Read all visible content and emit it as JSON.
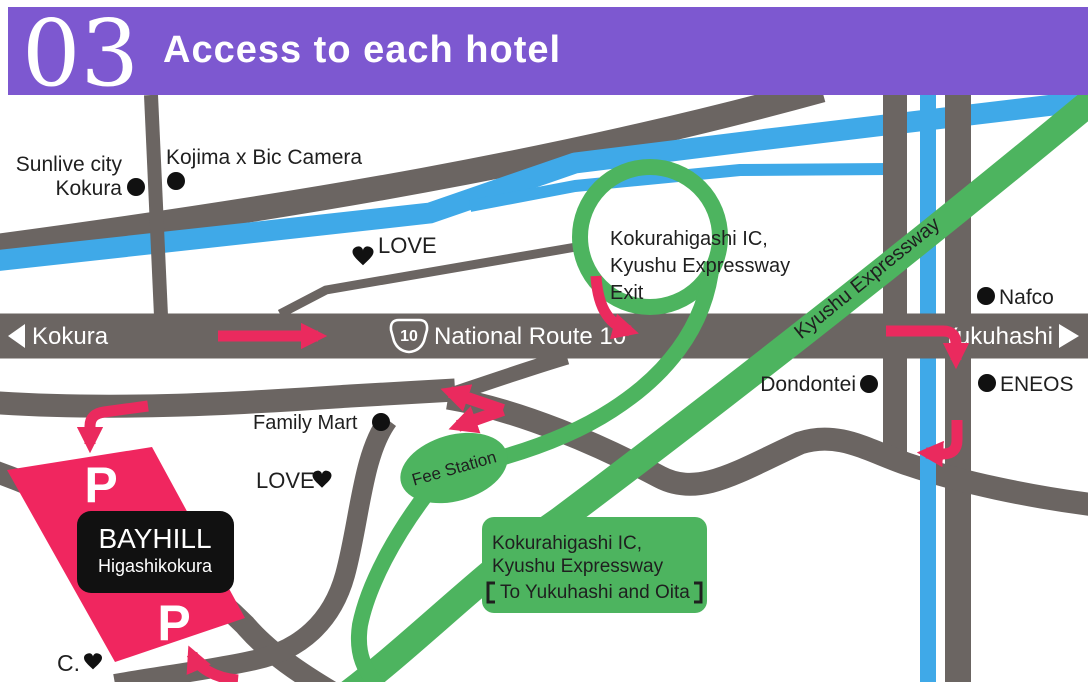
{
  "header": {
    "number": "03",
    "title": "Access to each hotel"
  },
  "colors": {
    "header_purple": "#7d58d0",
    "road_gray": "#6b6562",
    "water_blue": "#3fa9e8",
    "expressway_green": "#4db45f",
    "route_arrow_pink": "#ea2a5e",
    "hotel_block_pink": "#f0265f",
    "hotel_box_black": "#111111"
  },
  "route10": {
    "shield_number": "10",
    "name": "National Route 10",
    "west_label": "Kokura",
    "east_label": "Yukuhashi"
  },
  "expressway": {
    "band_label": "Kyushu Expressway",
    "exit_label": {
      "line1": "Kokurahigashi IC,",
      "line2": "Kyushu Expressway",
      "line3": "Exit"
    },
    "ic_box": {
      "line1": "Kokurahigashi IC,",
      "line2": "Kyushu Expressway",
      "line3": "【To Yukuhashi and Oita】",
      "line3_inner": "To Yukuhashi and Oita"
    },
    "fee_station": "Fee Station"
  },
  "pois": {
    "sunlive_line1": "Sunlive city",
    "sunlive_line2": "Kokura",
    "kojima": "Kojima x Bic Camera",
    "love_north": "LOVE",
    "love_south": "LOVE",
    "family_mart": "Family Mart",
    "dondontei": "Dondontei",
    "eneos": "ENEOS",
    "nafco": "Nafco",
    "c_spot": "C."
  },
  "hotel": {
    "name": "BAYHILL",
    "area": "Higashikokura",
    "parking_mark": "P"
  }
}
